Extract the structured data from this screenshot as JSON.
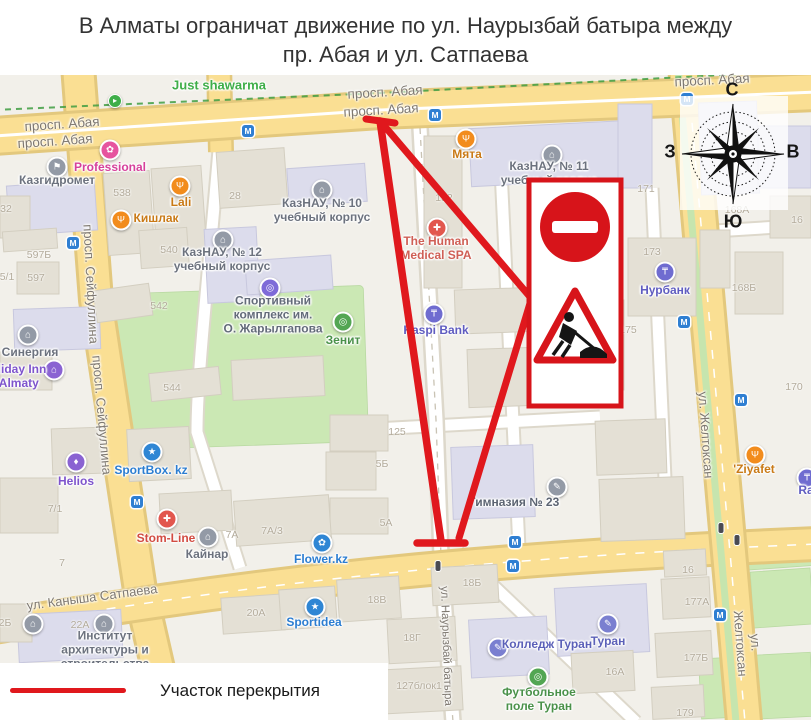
{
  "title": {
    "line1": "В Алматы ограничат движение по ул. Наурызбай батыра между",
    "line2": "пр. Абая и ул. Сатпаева"
  },
  "legend": {
    "label": "Участок перекрытия"
  },
  "compass": {
    "n": "С",
    "s": "Ю",
    "w": "З",
    "e": "В"
  },
  "sign_panel": {
    "signs": [
      "no-entry-sign",
      "road-works-sign"
    ]
  },
  "map": {
    "colors": {
      "map_bg": "#F2F0EA",
      "road_fill": "#FADF93",
      "road_casing": "#E3C87D",
      "minor_fill": "#FFFFFF",
      "minor_casing": "#DDD8CB",
      "building": "#E4E0D5",
      "building_stroke": "#D3CEC0",
      "civic": "#DCDCEC",
      "civic_stroke": "#C8C8DE",
      "green": "#CBE8B4",
      "bike_green": "#3F9D42",
      "red": "#E0181D",
      "sign_red": "#D7141A",
      "metro_blue": "#2F7FD2",
      "street_label": "#7E7870",
      "number_label": "#B3AB9B",
      "title_color": "#333333"
    },
    "metro_glyph": "М",
    "street_labels": [
      {
        "t": "просп. Абая",
        "x": 62,
        "y": 124,
        "r": -4,
        "s": 13.5
      },
      {
        "t": "просп. Абая",
        "x": 55,
        "y": 141,
        "r": -4,
        "s": 13.5
      },
      {
        "t": "просп. Абая",
        "x": 385,
        "y": 92,
        "r": -3.5,
        "s": 13.5
      },
      {
        "t": "просп. Абая",
        "x": 381,
        "y": 110,
        "r": -3.5,
        "s": 13.5
      },
      {
        "t": "просп. Абая",
        "x": 712,
        "y": 80,
        "r": -3,
        "s": 13.5
      },
      {
        "t": "просп. Сейфуллина",
        "x": 91,
        "y": 284,
        "r": 87,
        "s": 13
      },
      {
        "t": "просп. Сейфуллина",
        "x": 102,
        "y": 415,
        "r": 85,
        "s": 13
      },
      {
        "t": "ул. Каныша Сатпаева",
        "x": 92,
        "y": 597,
        "r": -7.5,
        "s": 13
      },
      {
        "t": "ул. Желтоксан",
        "x": 706,
        "y": 435,
        "r": 86,
        "s": 13
      },
      {
        "t": "ул. Желтоксан",
        "x": 748,
        "y": 643,
        "r": 86,
        "s": 13
      },
      {
        "t": "ул. Наурызбай батыра",
        "x": 446,
        "y": 646,
        "r": 88,
        "s": 11.5
      }
    ],
    "building_numbers": [
      {
        "t": "538",
        "x": 122,
        "y": 193
      },
      {
        "t": "28",
        "x": 235,
        "y": 196
      },
      {
        "t": "32",
        "x": 6,
        "y": 209
      },
      {
        "t": "540",
        "x": 169,
        "y": 250
      },
      {
        "t": "542",
        "x": 159,
        "y": 306
      },
      {
        "t": "544",
        "x": 172,
        "y": 388
      },
      {
        "t": "152",
        "x": 444,
        "y": 198
      },
      {
        "t": "125",
        "x": 397,
        "y": 432
      },
      {
        "t": "5Б",
        "x": 382,
        "y": 464
      },
      {
        "t": "5А",
        "x": 386,
        "y": 523
      },
      {
        "t": "597Б",
        "x": 39,
        "y": 255
      },
      {
        "t": "597",
        "x": 36,
        "y": 278
      },
      {
        "t": "5/1",
        "x": 7,
        "y": 277
      },
      {
        "t": "7/1",
        "x": 55,
        "y": 509
      },
      {
        "t": "7А",
        "x": 232,
        "y": 535
      },
      {
        "t": "7А/3",
        "x": 272,
        "y": 531
      },
      {
        "t": "7",
        "x": 62,
        "y": 563
      },
      {
        "t": "171",
        "x": 646,
        "y": 189
      },
      {
        "t": "173",
        "x": 652,
        "y": 252
      },
      {
        "t": "175",
        "x": 628,
        "y": 330
      },
      {
        "t": "168Б",
        "x": 744,
        "y": 288
      },
      {
        "t": "168А",
        "x": 737,
        "y": 210
      },
      {
        "t": "170",
        "x": 794,
        "y": 387
      },
      {
        "t": "16",
        "x": 797,
        "y": 220
      },
      {
        "t": "16",
        "x": 688,
        "y": 570
      },
      {
        "t": "177А",
        "x": 697,
        "y": 602
      },
      {
        "t": "177Б",
        "x": 696,
        "y": 658
      },
      {
        "t": "179",
        "x": 685,
        "y": 713
      },
      {
        "t": "16А",
        "x": 615,
        "y": 672
      },
      {
        "t": "18Б",
        "x": 472,
        "y": 583
      },
      {
        "t": "18В",
        "x": 377,
        "y": 600
      },
      {
        "t": "18Г",
        "x": 412,
        "y": 638
      },
      {
        "t": "127блок1",
        "x": 419,
        "y": 686
      },
      {
        "t": "22А",
        "x": 80,
        "y": 625
      },
      {
        "t": "2Б",
        "x": 5,
        "y": 623
      },
      {
        "t": "20А",
        "x": 256,
        "y": 613
      }
    ],
    "pois": [
      {
        "n": "just-shawarma",
        "t": "Just shawarma",
        "x": 115,
        "y": 101,
        "lx": 219,
        "ly": 86,
        "c": "#3FAE49",
        "tc": "#3FAE49",
        "g": "▸",
        "ts": 13,
        "sm": 1
      },
      {
        "n": "professional",
        "t": "Professional",
        "x": 110,
        "y": 150,
        "lx": 110,
        "ly": 168,
        "c": "#E6549F",
        "tc": "#D6409B",
        "g": "✿"
      },
      {
        "n": "kazgidromet",
        "t": "Казгидромет",
        "x": 57,
        "y": 167,
        "lx": 57,
        "ly": 181,
        "c": "#939AA6",
        "tc": "#6C727E",
        "g": "⚑"
      },
      {
        "n": "lali",
        "t": "Lali",
        "x": 180,
        "y": 186,
        "lx": 181,
        "ly": 203,
        "c": "#F28C1D",
        "tc": "#C97A16",
        "g": "Ψ"
      },
      {
        "n": "kishlak",
        "t": "Кишлак",
        "x": 121,
        "y": 220,
        "lx": 156,
        "ly": 219,
        "c": "#F28C1D",
        "tc": "#C97A16",
        "g": "Ψ"
      },
      {
        "n": "kaznau-12",
        "t": "КазНАУ, № 12\nучебный корпус",
        "x": 223,
        "y": 240,
        "lx": 222,
        "ly": 260,
        "c": "#939AA6",
        "tc": "#6C727E",
        "g": "⌂"
      },
      {
        "n": "kaznau-10",
        "t": "КазНАУ, № 10\nучебный корпус",
        "x": 322,
        "y": 190,
        "lx": 322,
        "ly": 211,
        "c": "#939AA6",
        "tc": "#6C727E",
        "g": "⌂"
      },
      {
        "n": "kaznau-11",
        "t": "КазНАУ, № 11\nучебный корпус",
        "x": 552,
        "y": 155,
        "lx": 549,
        "ly": 174,
        "c": "#939AA6",
        "tc": "#6C727E",
        "g": "⌂"
      },
      {
        "n": "myata",
        "t": "Мята",
        "x": 466,
        "y": 139,
        "lx": 467,
        "ly": 155,
        "c": "#F28C1D",
        "tc": "#C97A16",
        "g": "Ψ"
      },
      {
        "n": "human-medical-spa",
        "t": "The Human\nMedical SPA",
        "x": 437,
        "y": 228,
        "lx": 436,
        "ly": 249,
        "c": "#E2574E",
        "tc": "#CF5F55",
        "g": "✚"
      },
      {
        "n": "kaspi-bank",
        "t": "Kaspi Bank",
        "x": 434,
        "y": 314,
        "lx": 436,
        "ly": 331,
        "c": "#6F6CD0",
        "tc": "#5F5CC0",
        "g": "₸"
      },
      {
        "n": "zenit",
        "t": "Зенит",
        "x": 343,
        "y": 322,
        "lx": 343,
        "ly": 341,
        "c": "#53A653",
        "tc": "#4A9149",
        "g": "◎"
      },
      {
        "n": "sport-complex-zharylgapova",
        "t": "Спортивный\nкомплекс им.\nО. Жарылгапова",
        "x": 270,
        "y": 288,
        "lx": 273,
        "ly": 315,
        "c": "#7E6BD8",
        "tc": "#636B79",
        "g": "◎"
      },
      {
        "n": "nurbank",
        "t": "Нурбанк",
        "x": 665,
        "y": 272,
        "lx": 665,
        "ly": 291,
        "c": "#6F6CD0",
        "tc": "#5F5CC0",
        "g": "₸"
      },
      {
        "n": "gymnasium-23",
        "t": "Гимназия № 23",
        "x": 557,
        "y": 487,
        "lx": 514,
        "ly": 503,
        "c": "#939AA6",
        "tc": "#5C6472",
        "g": "✎"
      },
      {
        "n": "sportbox",
        "t": "SportBox. kz",
        "x": 152,
        "y": 452,
        "lx": 151,
        "ly": 471,
        "c": "#2F86D4",
        "tc": "#2B7DD1",
        "g": "★"
      },
      {
        "n": "helios",
        "t": "Helios",
        "x": 76,
        "y": 462,
        "lx": 76,
        "ly": 482,
        "c": "#8A63D2",
        "tc": "#7E54CC",
        "g": "♦"
      },
      {
        "n": "stom-line",
        "t": "Stom-Line",
        "x": 167,
        "y": 519,
        "lx": 166,
        "ly": 539,
        "c": "#E2574E",
        "tc": "#D24B41",
        "g": "✚"
      },
      {
        "n": "kainar",
        "t": "Кайнар",
        "x": 208,
        "y": 537,
        "lx": 207,
        "ly": 555,
        "c": "#939AA6",
        "tc": "#6C727E",
        "g": "⌂"
      },
      {
        "n": "flower-kz",
        "t": "Flower.kz",
        "x": 322,
        "y": 543,
        "lx": 321,
        "ly": 560,
        "c": "#2F86D4",
        "tc": "#2B7DD1",
        "g": "✿"
      },
      {
        "n": "sportidea",
        "t": "Sportidea",
        "x": 315,
        "y": 607,
        "lx": 314,
        "ly": 623,
        "c": "#2F86D4",
        "tc": "#2B7DD1",
        "g": "★"
      },
      {
        "n": "sinergia",
        "t": "Синергия",
        "x": 28,
        "y": 335,
        "lx": 30,
        "ly": 353,
        "c": "#939AA6",
        "tc": "#6C727E",
        "g": "⌂"
      },
      {
        "n": "holiday-inn",
        "t": "Holiday Inn\ns Almaty",
        "x": 54,
        "y": 370,
        "lx": 14,
        "ly": 377,
        "c": "#8A63D2",
        "tc": "#7E54CC",
        "g": "⌂"
      },
      {
        "n": "ziyafet",
        "t": "'Ziyafet",
        "x": 755,
        "y": 455,
        "lx": 754,
        "ly": 470,
        "c": "#F28C1D",
        "tc": "#C97A16",
        "g": "Ψ"
      },
      {
        "n": "turan",
        "t": "Туран",
        "x": 608,
        "y": 624,
        "lx": 608,
        "ly": 642,
        "c": "#7A7FD0",
        "tc": "#5B60B8",
        "g": "✎"
      },
      {
        "n": "college-turan",
        "t": "Колледж Туран",
        "x": 498,
        "y": 648,
        "lx": 547,
        "ly": 645,
        "c": "#7A7FD0",
        "tc": "#5B60B8",
        "g": "✎"
      },
      {
        "n": "football-field-turan",
        "t": "Футбольное\nполе Туран",
        "x": 538,
        "y": 677,
        "lx": 539,
        "ly": 700,
        "c": "#53A653",
        "tc": "#4A9149",
        "g": "◎"
      },
      {
        "n": "institute-architecture",
        "t": "Институт\nархитектуры и\nстроительства",
        "x": 104,
        "y": 624,
        "lx": 105,
        "ly": 650,
        "c": "#939AA6",
        "tc": "#6C727E",
        "g": "⌂"
      },
      {
        "n": "institute-architecture-2",
        "t": "",
        "x": 33,
        "y": 624,
        "lx": 0,
        "ly": 0,
        "c": "#939AA6",
        "tc": "#6C727E",
        "g": "⌂"
      },
      {
        "n": "ra",
        "t": "Ra",
        "x": 807,
        "y": 478,
        "lx": 806,
        "ly": 491,
        "c": "#6F6CD0",
        "tc": "#5F5CC0",
        "g": "₸"
      }
    ],
    "metro": [
      [
        248,
        131
      ],
      [
        73,
        243
      ],
      [
        435,
        115
      ],
      [
        687,
        99
      ],
      [
        684,
        322
      ],
      [
        741,
        400
      ],
      [
        137,
        502
      ],
      [
        515,
        542
      ],
      [
        513,
        566
      ],
      [
        720,
        615
      ]
    ],
    "traffic_lights": [
      [
        438,
        566
      ],
      [
        721,
        528
      ],
      [
        737,
        540
      ]
    ]
  }
}
